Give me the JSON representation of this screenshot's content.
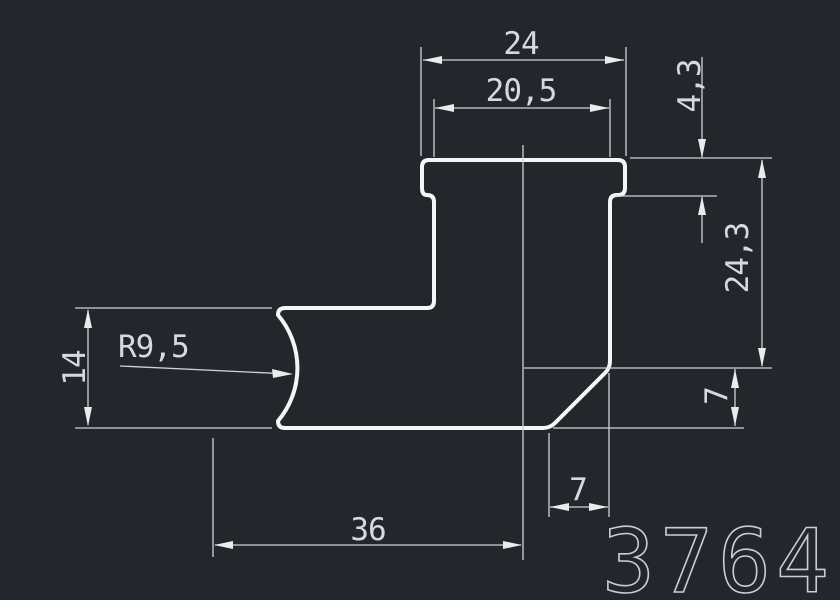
{
  "canvas": {
    "background_color": "#23262b",
    "outline_color": "#f3f5f7",
    "dimension_color": "#cfd4da",
    "text_color": "#d6d9de"
  },
  "drawing": {
    "part_number": "3764",
    "dimensions": {
      "flange_width": "24",
      "body_width": "20,5",
      "flange_thickness": "4,3",
      "right_height": "24,3",
      "chamfer_height": "7",
      "arm_height": "14",
      "radius_callout": "R9,5",
      "base_length": "36",
      "chamfer_width": "7"
    }
  }
}
